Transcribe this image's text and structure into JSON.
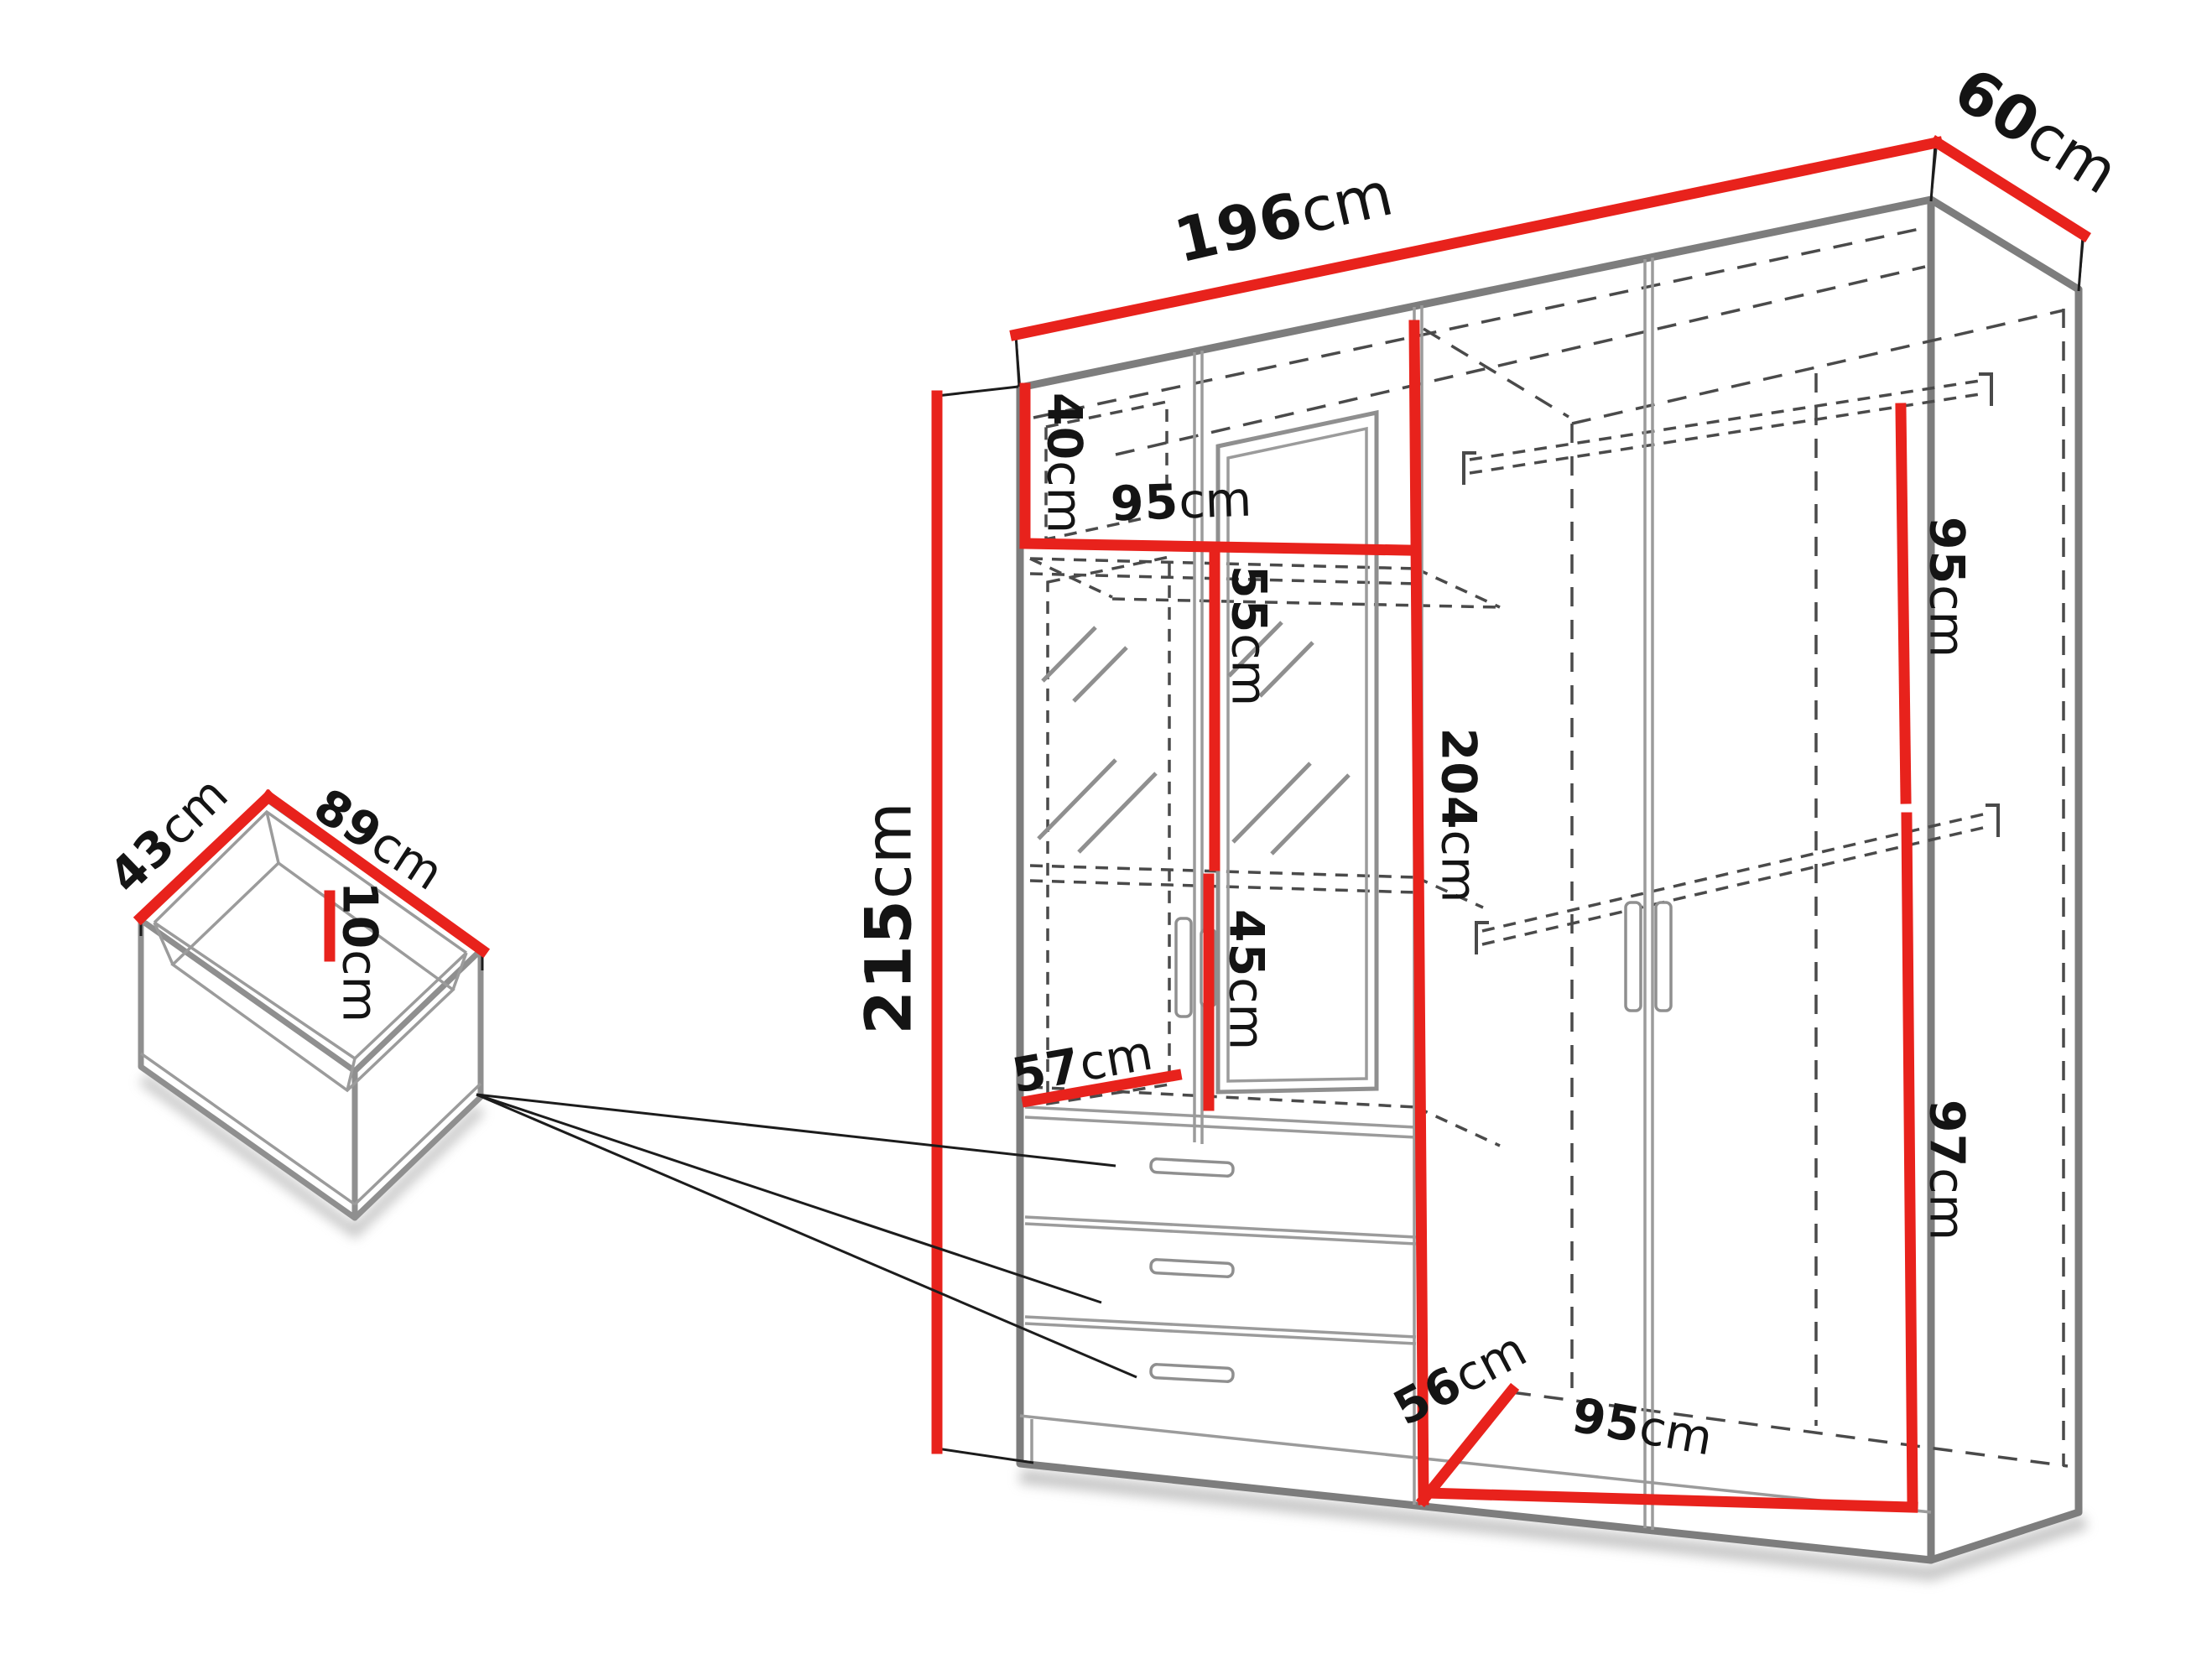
{
  "colors": {
    "dimension_line": "#e8221c",
    "outline": "#7d7d7d",
    "hidden_line": "#4a4a4a",
    "label_text": "#141414"
  },
  "wardrobe": {
    "width": {
      "value": "196",
      "unit": "cm"
    },
    "depth": {
      "value": "60",
      "unit": "cm"
    },
    "height": {
      "value": "215",
      "unit": "cm"
    },
    "interior": {
      "top_compartment_height": {
        "value": "40",
        "unit": "cm"
      },
      "top_shelf_width": {
        "value": "95",
        "unit": "cm"
      },
      "upper_left_compartment_height": {
        "value": "55",
        "unit": "cm"
      },
      "lower_left_compartment_height": {
        "value": "45",
        "unit": "cm"
      },
      "left_compartment_width": {
        "value": "57",
        "unit": "cm"
      },
      "interior_height": {
        "value": "204",
        "unit": "cm"
      },
      "right_upper_height": {
        "value": "95",
        "unit": "cm"
      },
      "right_lower_height": {
        "value": "97",
        "unit": "cm"
      },
      "floor_depth": {
        "value": "56",
        "unit": "cm"
      },
      "floor_width": {
        "value": "95",
        "unit": "cm"
      }
    }
  },
  "drawer": {
    "depth": {
      "value": "43",
      "unit": "cm"
    },
    "width": {
      "value": "89",
      "unit": "cm"
    },
    "inner_height": {
      "value": "10",
      "unit": "cm"
    }
  }
}
